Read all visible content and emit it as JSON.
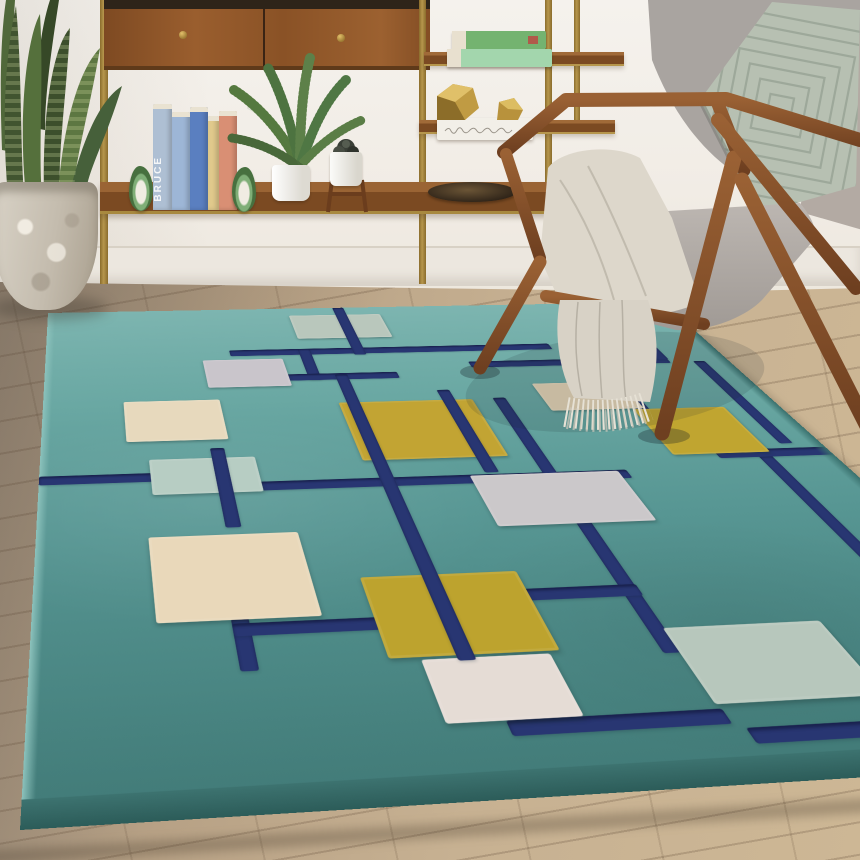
{
  "scene": {
    "type": "natural-image",
    "description": "Living room corner: teal wool rug with navy grid and multicolor squares, walnut mid-century armchair with gray cushions, sage quilted pillow and cream fringed throw, brass etagere with walnut shelves, books, plants and gold decor, snake plant in concrete planter, wood plank floor"
  },
  "palette": {
    "wall": "#f2eee8",
    "navy": "#283672",
    "rugTealFar": "#7db5b0",
    "rugTealNear": "#417a77",
    "mustard": "#c2a433",
    "cream": "#e7d9bd",
    "sage": "#b9c7bc",
    "lavenderGray": "#c9c5cb",
    "lightGray": "#cbc8ca",
    "walnut": "#8a5427",
    "chairWood": "#7b4728",
    "brass": "#a8893f",
    "cushionGray": "#b3aeaa",
    "pillowSage": "#b7c0b2",
    "throwCream": "#dbd5c9",
    "leafGreen": "#44592f",
    "floorWood": "#c3ac8d",
    "planterConcrete": "#cdc5b7"
  },
  "rug": {
    "name": "teal geometric area rug",
    "squares": [
      {
        "name": "sage-far",
        "x": 232,
        "y": 14,
        "w": 90,
        "h": 44,
        "color": "#b9c7bc"
      },
      {
        "name": "lavender-far",
        "x": 139,
        "y": 92,
        "w": 72,
        "h": 44,
        "color": "#c9c5cb"
      },
      {
        "name": "cream-top",
        "x": 66,
        "y": 154,
        "w": 80,
        "h": 55,
        "color": "#e7d9bd"
      },
      {
        "name": "mustard-right",
        "x": 245,
        "y": 163,
        "w": 115,
        "h": 78,
        "color": "#c2a433"
      },
      {
        "name": "cream-fringe",
        "x": 421,
        "y": 142,
        "w": 80,
        "h": 41,
        "color": "#e3d2b4"
      },
      {
        "name": "mustard-leg",
        "x": 491,
        "y": 184,
        "w": 80,
        "h": 62,
        "color": "#c0a530"
      },
      {
        "name": "sage-mid",
        "x": 82,
        "y": 232,
        "w": 81,
        "h": 41,
        "color": "#b7cdc3"
      },
      {
        "name": "gray-big",
        "x": 321,
        "y": 263,
        "w": 116,
        "h": 56,
        "color": "#cbc8ca"
      },
      {
        "name": "cream-big",
        "x": 76,
        "y": 317,
        "w": 103,
        "h": 76,
        "color": "#e9d8ba"
      },
      {
        "name": "mustard-center",
        "x": 211,
        "y": 362,
        "w": 105,
        "h": 66,
        "color": "#bda32e"
      },
      {
        "name": "white-pink",
        "x": 230,
        "y": 430,
        "w": 79,
        "h": 44,
        "color": "#e5dcd5"
      },
      {
        "name": "sage-right",
        "x": 388,
        "y": 415,
        "w": 103,
        "h": 56,
        "color": "#b7c7bc"
      }
    ],
    "lines": {
      "under": [
        {
          "x": 165,
          "y": 76,
          "w": 300,
          "h": 10
        },
        {
          "x": 228,
          "y": 76,
          "w": 11,
          "h": 52
        },
        {
          "x": 208,
          "y": 118,
          "w": 100,
          "h": 10
        },
        {
          "x": 378,
          "y": 104,
          "w": 186,
          "h": 10
        },
        {
          "x": 554,
          "y": 0,
          "w": 11,
          "h": 108
        },
        {
          "x": 122,
          "y": 392,
          "w": 11,
          "h": 40
        },
        {
          "x": 0,
          "y": 248,
          "w": 86,
          "h": 10
        },
        {
          "x": 162,
          "y": 262,
          "w": 282,
          "h": 10
        },
        {
          "x": 378,
          "y": 162,
          "w": 11,
          "h": 272
        },
        {
          "x": 314,
          "y": 378,
          "w": 76,
          "h": 10
        },
        {
          "x": 558,
          "y": 250,
          "w": 11,
          "h": 120
        },
        {
          "x": 586,
          "y": 112,
          "w": 11,
          "h": 124
        },
        {
          "x": 526,
          "y": 242,
          "w": 94,
          "h": 10
        },
        {
          "x": 264,
          "y": 474,
          "w": 126,
          "h": 10
        },
        {
          "x": 122,
          "y": 396,
          "w": 94,
          "h": 10
        },
        {
          "x": 396,
          "y": 487,
          "w": 168,
          "h": 10
        },
        {
          "x": 494,
          "y": 118,
          "w": 11,
          "h": 68
        }
      ],
      "over": [
        {
          "x": 278,
          "y": 0,
          "w": 11,
          "h": 88
        },
        {
          "x": 130,
          "y": 220,
          "w": 11,
          "h": 90
        },
        {
          "x": 252,
          "y": 120,
          "w": 11,
          "h": 312
        },
        {
          "x": 334,
          "y": 148,
          "w": 11,
          "h": 112
        }
      ]
    }
  },
  "shelf": {
    "standing_books": [
      {
        "label": "BRUCE",
        "color": "#aebfd3",
        "x": 0,
        "w": 19,
        "top": 0,
        "h": 106
      },
      {
        "label": "",
        "color": "#9db6d6",
        "x": 19,
        "w": 18,
        "top": 8,
        "h": 98
      },
      {
        "label": "",
        "color": "#5a7fc0",
        "x": 37,
        "w": 18,
        "top": 3,
        "h": 103
      },
      {
        "label": "",
        "color": "#e0c98c",
        "x": 55,
        "w": 11,
        "top": 12,
        "h": 94
      },
      {
        "label": "",
        "color": "#d98f74",
        "x": 66,
        "w": 18,
        "top": 7,
        "h": 99
      }
    ],
    "stacked_books": [
      {
        "color": "#74b370",
        "x": 452,
        "y": 31,
        "w": 94,
        "h": 18
      },
      {
        "color": "#a3d6ad",
        "x": 447,
        "y": 49,
        "w": 105,
        "h": 18
      }
    ]
  }
}
